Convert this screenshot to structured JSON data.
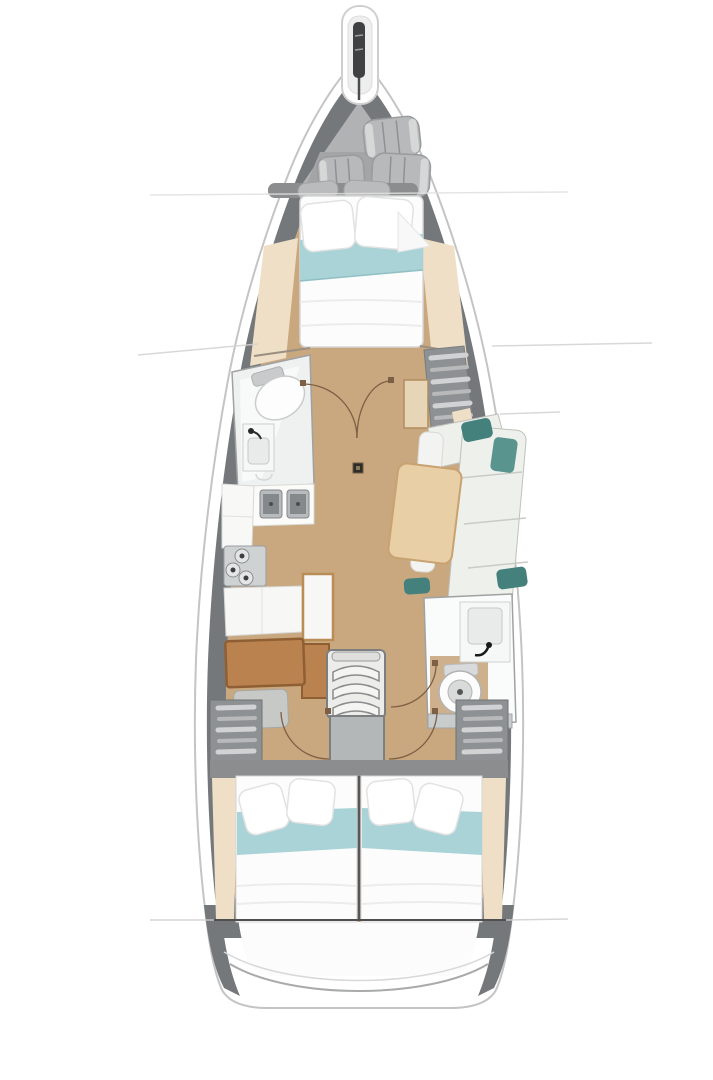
{
  "diagram": {
    "title": "Sailboat interior layout plan — top view",
    "type": "boat-floorplan",
    "areas": [
      {
        "id": "bowsprit",
        "label": "Bowsprit with anchor roller"
      },
      {
        "id": "bow-locker",
        "label": "Bow sail locker with three stowed fenders"
      },
      {
        "id": "forward-cabin",
        "label": "Forward cabin, double berth with two pillows and teal runner"
      },
      {
        "id": "forward-head",
        "label": "Forward head: toilet, washbasin, shower"
      },
      {
        "id": "saloon",
        "label": "Saloon: L-settee, teal cushions, dining table, mast post, double doors"
      },
      {
        "id": "galley",
        "label": "Galley: twin sinks, three-burner stove, cabinets"
      },
      {
        "id": "nav-station",
        "label": "Navigation station: chart desk and seat"
      },
      {
        "id": "companionway",
        "label": "Companionway: three steps and landing platform"
      },
      {
        "id": "aft-head",
        "label": "Aft head: washbasin and toilet"
      },
      {
        "id": "lockers",
        "label": "Port and starboard shelved hanging lockers"
      },
      {
        "id": "aft-cabin-port",
        "label": "Aft port cabin, double berth with teal runner"
      },
      {
        "id": "aft-cabin-starboard",
        "label": "Aft starboard cabin, double berth with teal runner"
      },
      {
        "id": "stern",
        "label": "Stern transom platform"
      }
    ],
    "colors": {
      "hull_white": "#ffffff",
      "hull_outline": "#c4c4c4",
      "hull_band": "#75787a",
      "deck": "#e9e9e9",
      "floor_wood": "#c9a87f",
      "bow_locker": "#b0b2b3",
      "bow_locker_inner": "#a3a5a6",
      "fender_gray": "#b7b9ba",
      "bulkhead_gray": "#8b8d8f",
      "mattress": "#fcfcfc",
      "blanket_teal": "#a9d3d6",
      "pillow_gray": "#b9bbbc",
      "shelf_cream": "#eedfc6",
      "locker_gray": "#8e9193",
      "locker_slat": "#d0d2d3",
      "table_wood": "#e9cfa6",
      "desk_wood": "#b9824f",
      "settee": "#eef0ec",
      "cushion_teal": "#44817d",
      "bench_white": "#f7f7f5",
      "steel": "#b7bbbd",
      "stove_gray": "#cfd2d3",
      "steps_gray": "#ececeb",
      "platform_gray": "#b4b7b8",
      "head_panel": "#eff1f1",
      "porcelain": "#fdfdfd",
      "door_arc": "#7d5f46",
      "annotation": "#d2d2d2",
      "dark_line": "#4f4f4f",
      "anchor_dark": "#3f4142"
    }
  }
}
